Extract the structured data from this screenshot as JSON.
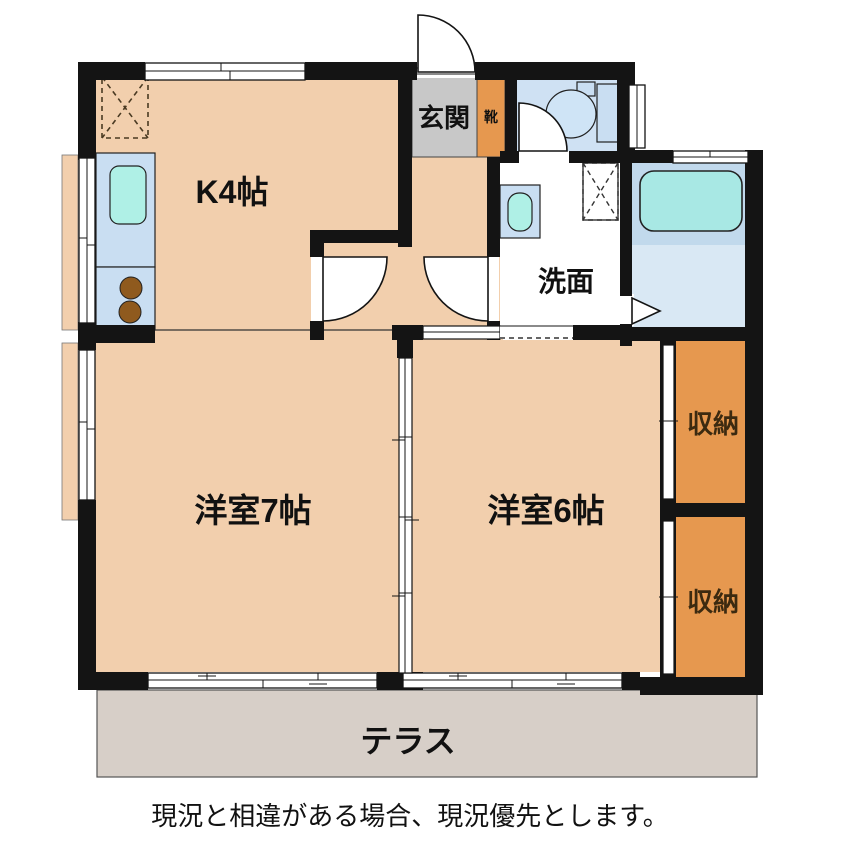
{
  "floorplan": {
    "type": "apartment-floor-plan",
    "rooms": {
      "kitchen": {
        "label": "K4帖"
      },
      "entrance": {
        "label": "玄関"
      },
      "shoe_cabinet": {
        "label": "靴"
      },
      "washroom": {
        "label": "洗面"
      },
      "western_room_7": {
        "label": "洋室7帖"
      },
      "western_room_6": {
        "label": "洋室6帖"
      },
      "storage_upper": {
        "label": "収納"
      },
      "storage_lower": {
        "label": "収納"
      },
      "terrace": {
        "label": "テラス"
      }
    },
    "fixtures": [
      "refrigerator-space",
      "kitchen-sink",
      "stove-burners",
      "washbasin",
      "washing-machine-space",
      "toilet",
      "bathtub"
    ],
    "colors": {
      "wall": "#141414",
      "room_floor": "#f2cfad",
      "entrance_floor": "#c8c8c8",
      "storage_orange": "#e6984f",
      "water_floor_blue": "#cfe1f3",
      "counter_blue": "#c9def2",
      "fixture_cyan": "#aff0e6",
      "bath_floor": "#d9e8f4",
      "tub_surround": "#c1d9ec",
      "tub_cyan": "#a8e8e4",
      "terrace_gray": "#d7cfc8",
      "stove_brown": "#8f5a1e",
      "text": "#111111"
    }
  },
  "caption": "現況と相違がある場合、現況優先とします。"
}
